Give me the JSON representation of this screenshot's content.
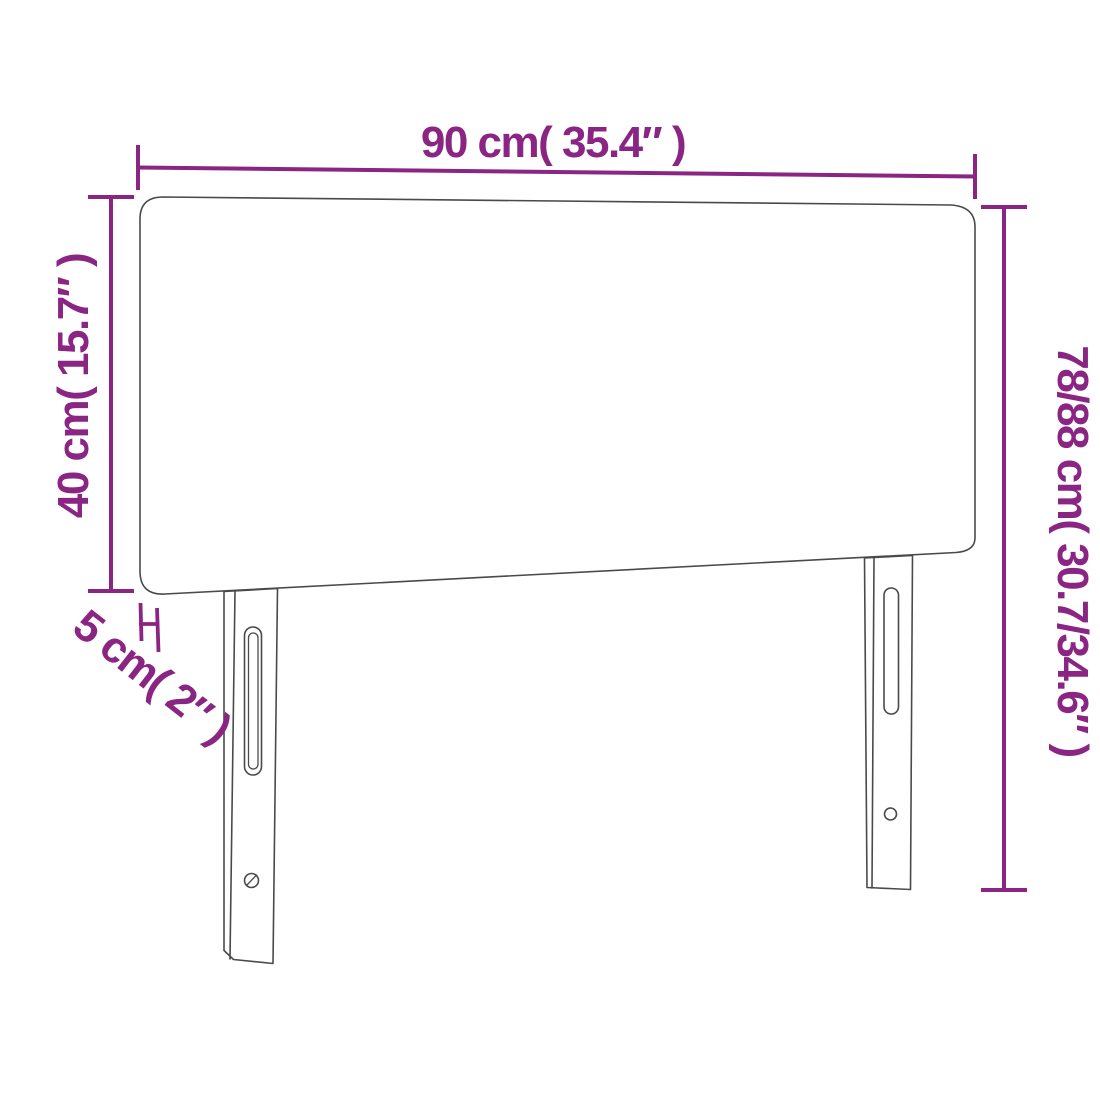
{
  "diagram": {
    "labels": {
      "width": "90 cm( 35.4″ )",
      "height_left": "40 cm( 15.7″ )",
      "height_right": "78/88 cm( 30.7/34.6″ )",
      "depth": "5 cm( 2″ )"
    },
    "colors": {
      "dimension": "#8B2583",
      "outline": "#4A4A4A",
      "background": "#FFFFFF"
    }
  }
}
